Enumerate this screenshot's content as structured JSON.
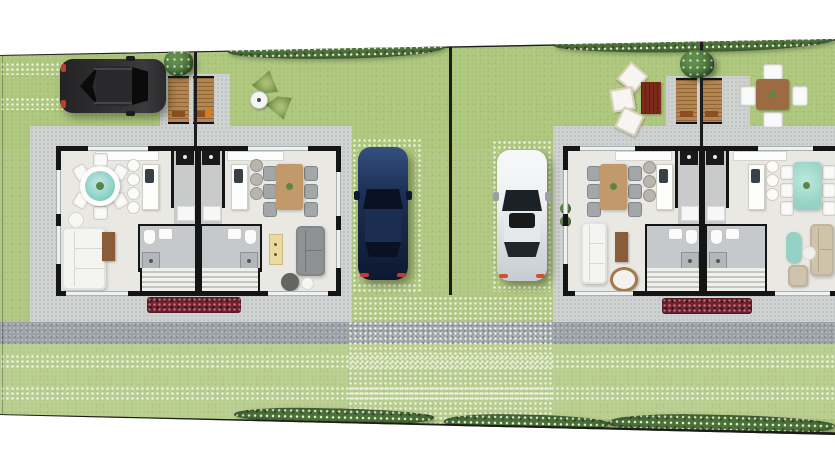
{
  "meta": {
    "description": "Top-down 3D rendered architectural site plan of two mirrored duplex houses on adjacent lots, with landscaped yards, hedgerows, paver walkways, a sidewalk, entry decks and three parked cars",
    "view": "top-down render",
    "canvas": {
      "width": 835,
      "height": 467
    }
  },
  "colors": {
    "page": "#ffffff",
    "grass": "#afc781",
    "yardgreen": "#a9c578",
    "lawnlight": "#bdd196",
    "bush": "#4c7138",
    "bushdot": "#e9f2e0",
    "line": "#1c1c1c",
    "concrete": "#cfd2d0",
    "walkgray": "#9aa1a8",
    "paverdot": "#eef3e2",
    "floor": "#eae8e3",
    "wall": "#151515",
    "bath": "#c6c9cb",
    "corridor": "#c9cbca",
    "stairstripe": "#f0f0ed",
    "flowerbed": "#6c2531",
    "flowerdot": "#d26a77",
    "wood": "#c1996a",
    "wooddark": "#8a5c38",
    "deckwood": "#b5854f",
    "deckmat": "#8a4f22",
    "teal": "#86ccc2",
    "tealglass": "#93d2c4",
    "sofawhite": "#f4f4f1",
    "sofagray": "#8f9294",
    "sofabeige": "#cfc3ac",
    "consoleyellow": "#ead9a0",
    "pouf": "#63665e",
    "suvbody": "#2d2d2f",
    "suvglass": "#0b0b0c",
    "carblue": "#1d2f55",
    "carwhite": "#eef0f2",
    "carglass": "#1b2227",
    "chairwhite": "#fafaf8",
    "chairgray": "#a4a7a9",
    "stoolgray": "#b9b5ae",
    "appliance": "#19191b",
    "rugred": "#7c2b1b",
    "outtable": "#9c6b44",
    "sink": "#394045",
    "shower": "#b4b7ba",
    "accentorange": "#e07818",
    "taillight": "#c33b2f",
    "plantgreen": "#5d8549",
    "plantdark": "#3f6634"
  },
  "site": {
    "lots": [
      {
        "name": "left-lot",
        "building": "duplex house 1 with two mirrored units",
        "vehicles": [
          "dark SUV on grass-paver driveway",
          "dark blue car on grass-paver parking pad"
        ],
        "yard_features": [
          "twin wooden entry decks with door mats",
          "shade tree",
          "two agave plants",
          "bird bath",
          "street hedgerow"
        ]
      },
      {
        "name": "right-lot",
        "building": "duplex house 2 with two mirrored units",
        "vehicles": [
          "white car on grass-paver parking pad"
        ],
        "yard_features": [
          "twin wooden entry decks with door mats",
          "shade tree",
          "three white lounge cushions with dark red mat",
          "outdoor dining table with four white chairs",
          "street hedgerow"
        ]
      }
    ],
    "rooms_per_unit": [
      "living room",
      "dining area",
      "kitchen with island and stools",
      "bathroom",
      "staircase",
      "entry hall with washer and door mat"
    ],
    "landscape_elements": [
      "top hedgerow",
      "bottom hedgerow",
      "concrete aprons",
      "gray sidewalk band",
      "two horizontal grass-paver strips",
      "central paver walkway",
      "red flower beds at house fronts"
    ]
  }
}
